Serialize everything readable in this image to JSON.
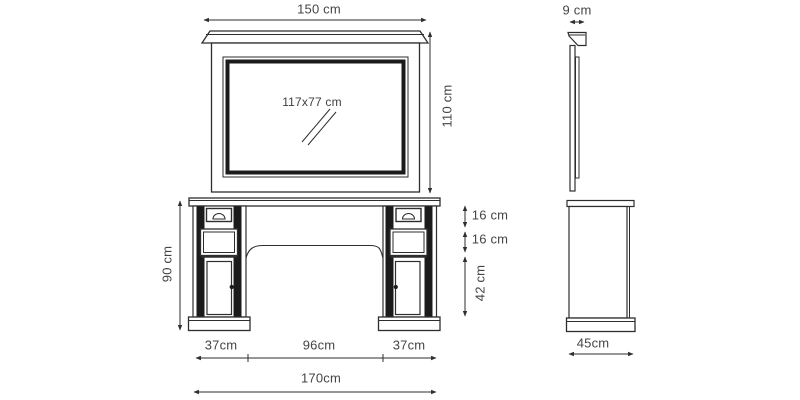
{
  "page": {
    "title": "Furniture technical dimension drawing — mirror and dressing console, front and side views",
    "background": "#ffffff"
  },
  "colors": {
    "line": "#2e2e2e",
    "dark_fill": "#1b1b1b",
    "text": "#454545"
  },
  "labels": {
    "mirror_width": "150 cm",
    "mirror_height": "110 cm",
    "mirror_glass": "117x77 cm",
    "mirror_depth": "9 cm",
    "console_height": "90 cm",
    "drawer_top_height": "16 cm",
    "drawer_middle_height": "16 cm",
    "door_height": "42 cm",
    "pedestal_left_width": "37cm",
    "knee_space_width": "96cm",
    "pedestal_right_width": "37cm",
    "console_total_width": "170cm",
    "console_depth": "45cm"
  },
  "views": [
    {
      "id": "mirror-front-view",
      "dimensions": [
        "150 cm",
        "110 cm",
        "117x77 cm"
      ]
    },
    {
      "id": "mirror-side-view",
      "dimensions": [
        "9 cm"
      ]
    },
    {
      "id": "console-front-view",
      "dimensions": [
        "90 cm",
        "16 cm",
        "16 cm",
        "42 cm",
        "37cm",
        "96cm",
        "37cm",
        "170cm"
      ]
    },
    {
      "id": "console-side-view",
      "dimensions": [
        "45cm"
      ]
    }
  ]
}
